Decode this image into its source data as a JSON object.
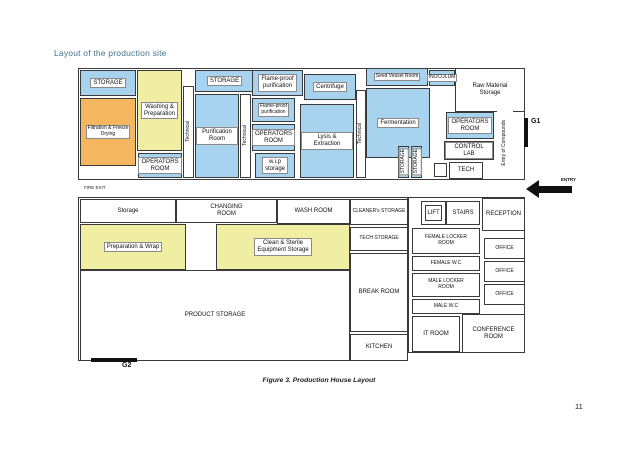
{
  "document": {
    "heading": "Layout of the production site",
    "figure_caption": "Figure 3. Production House Layout",
    "page_number": "11"
  },
  "colors": {
    "blue": "#A8D3EE",
    "yellow": "#F0EEA2",
    "orange": "#F5B660",
    "white": "#FFFFFF",
    "wall": "#3A3A3A",
    "heading_text": "#44708F"
  },
  "plan": {
    "markers": {
      "gate1": "G1",
      "gate2": "G2",
      "entry": "ENTRY",
      "fire_exit": "FIRE EXIT"
    },
    "rooms": [
      {
        "id": "storage-1",
        "label": "STORAGE",
        "color": "blue",
        "x": 80,
        "y": 70,
        "w": 56,
        "h": 26,
        "boxed": true
      },
      {
        "id": "washing-preparation",
        "label": "Washing &\nPreparation",
        "color": "yellow",
        "x": 137,
        "y": 70,
        "w": 45,
        "h": 81,
        "boxed": true
      },
      {
        "id": "filtration-freeze-drying",
        "label": "Filtration & Freeze\nDrying",
        "color": "orange",
        "x": 80,
        "y": 98,
        "w": 56,
        "h": 68,
        "boxed": true,
        "tiny": true
      },
      {
        "id": "operators-room-1",
        "label": "OPERATORS\nROOM",
        "color": "blue",
        "x": 138,
        "y": 153,
        "w": 44,
        "h": 25,
        "boxed": true
      },
      {
        "id": "technical-1",
        "label": "Technical",
        "color": "white",
        "x": 183,
        "y": 86,
        "w": 11,
        "h": 92,
        "vertical": true,
        "tiny": true
      },
      {
        "id": "storage-2",
        "label": "STORAGE",
        "color": "blue",
        "x": 195,
        "y": 70,
        "w": 59,
        "h": 22,
        "boxed": true
      },
      {
        "id": "purification-room",
        "label": "Purification Room",
        "color": "blue",
        "x": 195,
        "y": 94,
        "w": 44,
        "h": 84,
        "boxed": true
      },
      {
        "id": "technical-2",
        "label": "Technical",
        "color": "white",
        "x": 240,
        "y": 94,
        "w": 11,
        "h": 84,
        "vertical": true,
        "tiny": true
      },
      {
        "id": "flameproof-purification-1",
        "label": "Flame-proof\npurification",
        "color": "blue",
        "x": 252,
        "y": 70,
        "w": 51,
        "h": 26,
        "boxed": true
      },
      {
        "id": "flameproof-purification-2",
        "label": "Flame-proof\npurification",
        "color": "blue",
        "x": 252,
        "y": 98,
        "w": 43,
        "h": 24,
        "boxed": true,
        "tiny": true
      },
      {
        "id": "operators-room-2",
        "label": "OPERATORS\nROOM",
        "color": "blue",
        "x": 252,
        "y": 124,
        "w": 43,
        "h": 27,
        "boxed": true
      },
      {
        "id": "wip-storage",
        "label": "w.i.p\nstorage",
        "color": "blue",
        "x": 255,
        "y": 153,
        "w": 40,
        "h": 25,
        "boxed": true
      },
      {
        "id": "centrifuge",
        "label": "Centrifuge",
        "color": "blue",
        "x": 304,
        "y": 74,
        "w": 52,
        "h": 26,
        "boxed": true
      },
      {
        "id": "lysis-extraction",
        "label": "Lysis & Extraction",
        "color": "blue",
        "x": 300,
        "y": 104,
        "w": 54,
        "h": 74,
        "boxed": true
      },
      {
        "id": "technical-3",
        "label": "Technical",
        "color": "white",
        "x": 356,
        "y": 90,
        "w": 10,
        "h": 88,
        "vertical": true,
        "tiny": true
      },
      {
        "id": "seed-vessel-room",
        "label": "Seed Vessel Room",
        "color": "blue",
        "x": 366,
        "y": 68,
        "w": 62,
        "h": 18,
        "boxed": true,
        "tiny": true
      },
      {
        "id": "inoculum",
        "label": "INOCULUM",
        "color": "blue",
        "x": 429,
        "y": 70,
        "w": 26,
        "h": 16,
        "boxed": true,
        "tiny": true
      },
      {
        "id": "fermentation",
        "label": "Fermentation",
        "color": "blue",
        "x": 366,
        "y": 88,
        "w": 64,
        "h": 70,
        "boxed": true
      },
      {
        "id": "storage-3",
        "label": "STORAGE",
        "color": "blue",
        "x": 398,
        "y": 146,
        "w": 11,
        "h": 32,
        "vertical": true,
        "boxed": true,
        "tiny": true
      },
      {
        "id": "storage-4",
        "label": "STORAGE",
        "color": "blue",
        "x": 411,
        "y": 146,
        "w": 11,
        "h": 32,
        "vertical": true,
        "boxed": true,
        "tiny": true
      },
      {
        "id": "raw-material-storage",
        "label": "Raw Material\nStorage",
        "color": "white",
        "x": 455,
        "y": 68,
        "w": 70,
        "h": 44
      },
      {
        "id": "operators-room-3",
        "label": "OPERATORS\nROOM",
        "color": "blue",
        "x": 446,
        "y": 112,
        "w": 48,
        "h": 27,
        "boxed": true
      },
      {
        "id": "control-lab",
        "label": "CONTROL LAB",
        "color": "blue",
        "x": 444,
        "y": 141,
        "w": 50,
        "h": 19,
        "boxed": true
      },
      {
        "id": "small-closet",
        "label": "",
        "color": "white",
        "x": 434,
        "y": 163,
        "w": 13,
        "h": 14
      },
      {
        "id": "tech",
        "label": "TECH",
        "color": "white",
        "x": 449,
        "y": 162,
        "w": 34,
        "h": 17
      },
      {
        "id": "entry-of-compounds",
        "label": "Entry of Compounds",
        "color": "white",
        "x": 497,
        "y": 110,
        "w": 16,
        "h": 66,
        "vertical": true,
        "noborder": true,
        "tiny": true
      },
      {
        "id": "storage-5",
        "label": "Storage",
        "color": "white",
        "x": 80,
        "y": 199,
        "w": 96,
        "h": 24
      },
      {
        "id": "changing-room",
        "label": "CHANGING\nROOM",
        "color": "white",
        "x": 176,
        "y": 199,
        "w": 101,
        "h": 24
      },
      {
        "id": "wash-room",
        "label": "WASH ROOM",
        "color": "white",
        "x": 277,
        "y": 199,
        "w": 73,
        "h": 25
      },
      {
        "id": "cleaners-storage",
        "label": "CLEANER's STORAGE",
        "color": "white",
        "x": 350,
        "y": 199,
        "w": 58,
        "h": 26,
        "tiny": true
      },
      {
        "id": "tech-storage",
        "label": "TECH STORAGE",
        "color": "white",
        "x": 350,
        "y": 227,
        "w": 58,
        "h": 24,
        "tiny": true
      },
      {
        "id": "preparation-wrap",
        "label": "Preparation & Wrap",
        "color": "yellow",
        "x": 80,
        "y": 224,
        "w": 106,
        "h": 46,
        "boxed": true
      },
      {
        "id": "clean-sterile-equipment-storage",
        "label": "Clean & Sterile\nEquipment Storage",
        "color": "yellow",
        "x": 216,
        "y": 224,
        "w": 134,
        "h": 46,
        "boxed": true
      },
      {
        "id": "product-storage",
        "label": "PRODUCT STORAGE",
        "color": "white",
        "x": 80,
        "y": 270,
        "w": 270,
        "h": 91
      },
      {
        "id": "break-room",
        "label": "BREAK ROOM",
        "color": "white",
        "x": 350,
        "y": 253,
        "w": 58,
        "h": 79
      },
      {
        "id": "kitchen",
        "label": "KITCHEN",
        "color": "white",
        "x": 350,
        "y": 334,
        "w": 58,
        "h": 27
      },
      {
        "id": "lift",
        "label": "LIFT",
        "color": "white",
        "x": 421,
        "y": 201,
        "w": 25,
        "h": 24,
        "inner": true
      },
      {
        "id": "stairs",
        "label": "STAIRS",
        "color": "white",
        "x": 446,
        "y": 201,
        "w": 34,
        "h": 24
      },
      {
        "id": "reception",
        "label": "RECEPTION",
        "color": "white",
        "x": 482,
        "y": 198,
        "w": 43,
        "h": 33
      },
      {
        "id": "female-locker-room",
        "label": "FEMALE LOCKER\nROOM",
        "color": "white",
        "x": 412,
        "y": 228,
        "w": 68,
        "h": 26,
        "tiny": true
      },
      {
        "id": "female-wc",
        "label": "FEMALE W.C",
        "color": "white",
        "x": 412,
        "y": 256,
        "w": 68,
        "h": 15,
        "tiny": true
      },
      {
        "id": "office-1",
        "label": "OFFICE",
        "color": "white",
        "x": 484,
        "y": 238,
        "w": 41,
        "h": 21,
        "tiny": true
      },
      {
        "id": "office-2",
        "label": "OFFICE",
        "color": "white",
        "x": 484,
        "y": 261,
        "w": 41,
        "h": 21,
        "tiny": true
      },
      {
        "id": "male-locker-room",
        "label": "MALE LOCKER\nROOM",
        "color": "white",
        "x": 412,
        "y": 273,
        "w": 68,
        "h": 24,
        "tiny": true
      },
      {
        "id": "male-wc",
        "label": "MALE W.C",
        "color": "white",
        "x": 412,
        "y": 299,
        "w": 68,
        "h": 15,
        "tiny": true
      },
      {
        "id": "office-3",
        "label": "OFFICE",
        "color": "white",
        "x": 484,
        "y": 284,
        "w": 41,
        "h": 21,
        "tiny": true
      },
      {
        "id": "it-room",
        "label": "IT ROOM",
        "color": "white",
        "x": 412,
        "y": 316,
        "w": 48,
        "h": 36
      },
      {
        "id": "conference-room",
        "label": "CONFERENCE\nROOM",
        "color": "white",
        "x": 462,
        "y": 314,
        "w": 63,
        "h": 39
      }
    ]
  }
}
